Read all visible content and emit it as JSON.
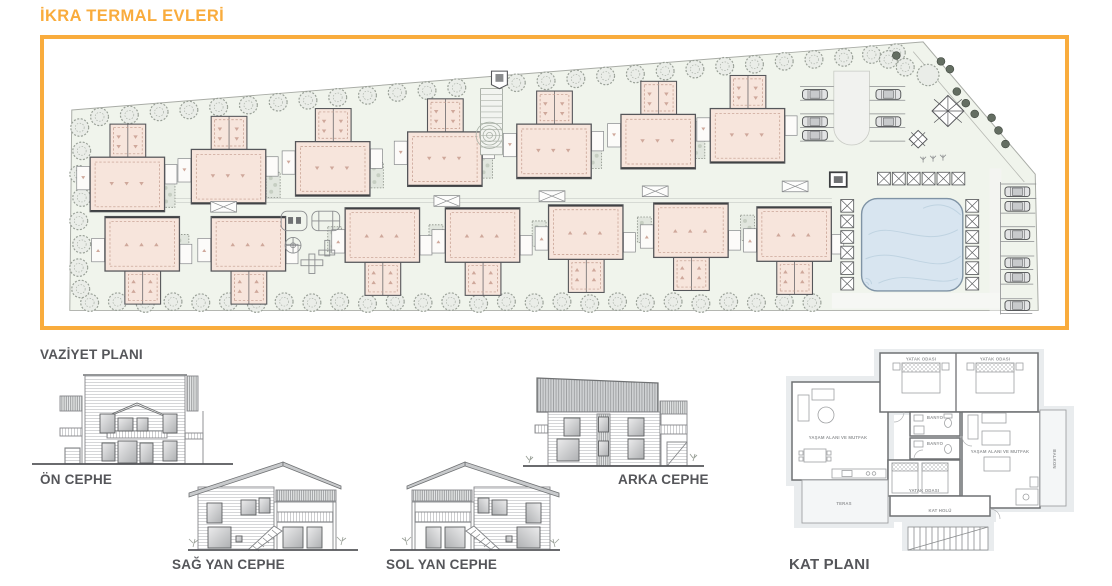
{
  "title": "İKRA TERMAL EVLERİ",
  "drawings": {
    "site_plan": {
      "label": "VAZİYET PLANI"
    },
    "elevation_front": {
      "label": "ÖN CEPHE"
    },
    "elevation_right": {
      "label": "SAĞ YAN CEPHE"
    },
    "elevation_left": {
      "label": "SOL YAN CEPHE"
    },
    "elevation_back": {
      "label": "ARKA CEPHE"
    },
    "floor_plan": {
      "label": "KAT PLANI"
    }
  },
  "floor_plan_rooms": {
    "bedroom_1": "YATAK ODASI",
    "bedroom_2": "YATAK ODASI",
    "bedroom_3": "YATAK ODASI",
    "bathroom_1": "BANYO",
    "bathroom_2": "BANYO",
    "living_kitchen_1": "YAŞAM ALANI VE MUTFAK",
    "living_kitchen_2": "YAŞAM ALANI VE MUTFAK",
    "balcony": "BALKON",
    "terrace": "TERAS",
    "hall": "KAT HOLÜ"
  },
  "colors": {
    "accent_orange": "#F9AC3D",
    "label_gray": "#55565A",
    "building_fill": "#F7E5DC",
    "site_ground_green": "#F0F4EC",
    "pool_blue": "#D8E5F0",
    "drawing_line_gray": "#7A7C7E"
  }
}
